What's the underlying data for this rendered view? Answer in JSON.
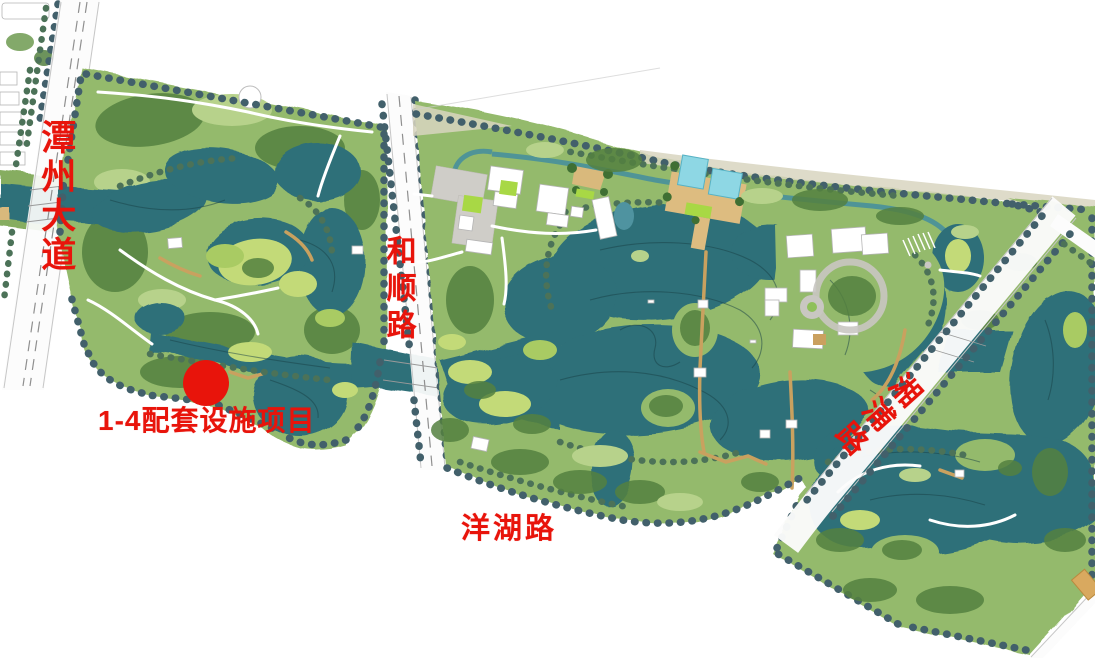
{
  "map": {
    "kind": "park-master-plan",
    "roads": [
      {
        "id": "tanzhou-avenue",
        "name": "潭州大道",
        "orientation": "vertical"
      },
      {
        "id": "heshun-road",
        "name": "和顺路",
        "orientation": "vertical"
      },
      {
        "id": "yanghu-road",
        "name": "洋湖路",
        "orientation": "horizontal"
      },
      {
        "id": "xiangpu-road",
        "name": "湘浦路",
        "orientation": "diagonal"
      }
    ],
    "marker": {
      "label": "1-4配套设施项目",
      "color": "#e8140b"
    },
    "colors": {
      "water": "#2e6f79",
      "water_light": "#4f93a0",
      "vegetation": "#94ba6c",
      "vegetation_light": "#b7d28b",
      "tree_dark": "#54803f",
      "tree_row": "#42606b",
      "marsh": "#c3da78",
      "pool": "#8ed7e4",
      "deck": "#ddbc80",
      "plaza": "#cfcdc8",
      "road": "#fcfcfc",
      "building": "#ffffff",
      "accent_red": "#e8140b"
    }
  }
}
